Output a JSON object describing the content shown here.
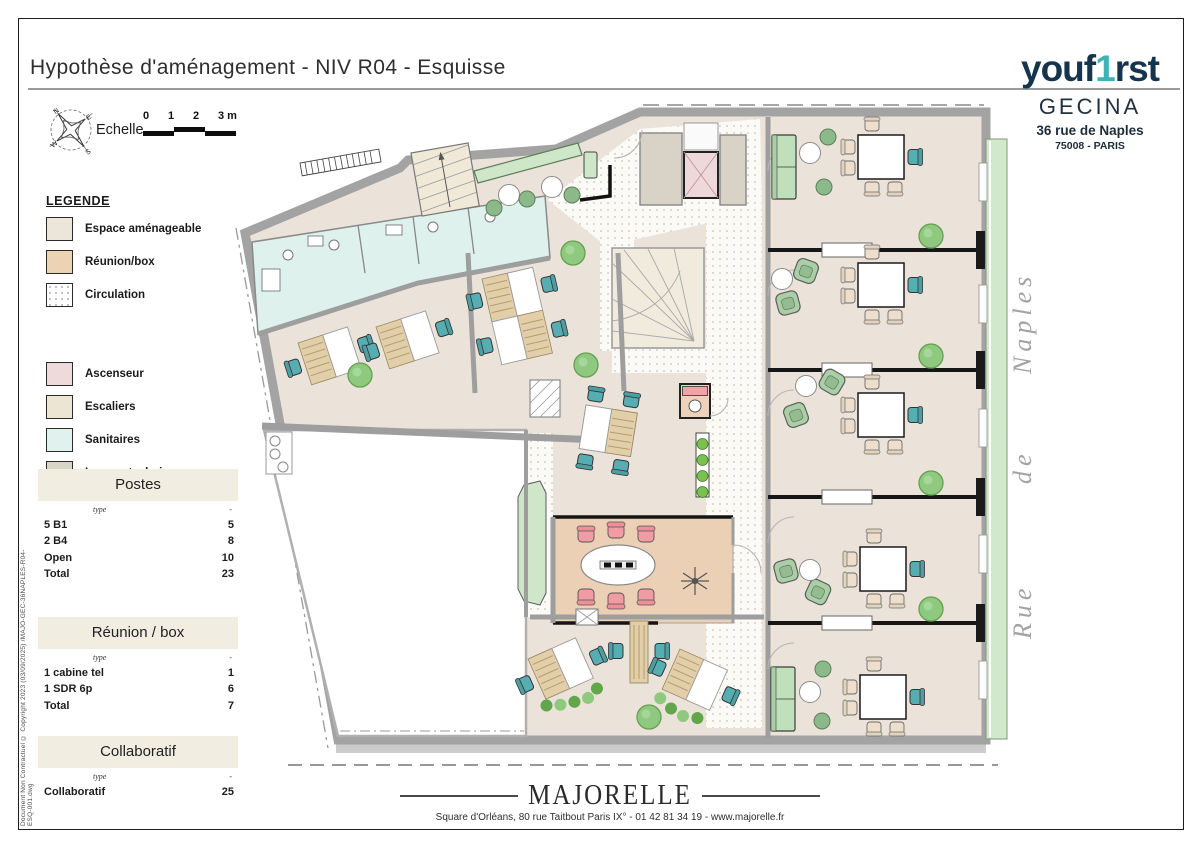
{
  "title": "Hypothèse d'aménagement - NIV R04 - Esquisse",
  "logo": {
    "part1": "youf",
    "accent": "1",
    "part2": "rst"
  },
  "client": {
    "name": "GECINA",
    "address1": "36 rue de Naples",
    "address2": "75008 - PARIS"
  },
  "scale": {
    "label": "Echelle",
    "t0": "0",
    "t1": "1",
    "t2": "2",
    "t3": "3 m"
  },
  "compass": {
    "n": "N",
    "e": "E",
    "s": "S",
    "w": "W"
  },
  "legend": {
    "title": "LEGENDE",
    "items": [
      {
        "label": "Espace aménageable",
        "color": "#ece6da"
      },
      {
        "label": "Réunion/box",
        "color": "#ecd3b4"
      },
      {
        "label": "Circulation",
        "color": "#ffffff"
      },
      {
        "label": "Ascenseur",
        "color": "#eedada"
      },
      {
        "label": "Escaliers",
        "color": "#ece5d4"
      },
      {
        "label": "Sanitaires",
        "color": "#e1f2ee"
      },
      {
        "label": "Locaux techniques",
        "color": "#d9d5c7"
      }
    ]
  },
  "tables": {
    "postes": {
      "title": "Postes",
      "type_label": "type",
      "value_label": "-",
      "rows": [
        {
          "label": "5 B1",
          "value": "5"
        },
        {
          "label": "2 B4",
          "value": "8"
        },
        {
          "label": "Open",
          "value": "10"
        },
        {
          "label": "Total",
          "value": "23"
        }
      ]
    },
    "reunion": {
      "title": "Réunion / box",
      "type_label": "type",
      "value_label": "-",
      "rows": [
        {
          "label": "1 cabine tel",
          "value": "1"
        },
        {
          "label": "1 SDR 6p",
          "value": "6"
        },
        {
          "label": "Total",
          "value": "7"
        }
      ]
    },
    "collaboratif": {
      "title": "Collaboratif",
      "type_label": "type",
      "value_label": "-",
      "rows": [
        {
          "label": "Collaboratif",
          "value": "25"
        }
      ]
    }
  },
  "street": {
    "word1": "Naples",
    "word2": "de",
    "word3": "Rue"
  },
  "footer": {
    "brand": "MAJORELLE",
    "address": "Square d'Orléans, 80 rue Taitbout Paris IX° - 01 42 81 34 19 - www.majorelle.fr"
  },
  "side_note": "Document Non Contractuel © Copyright 2023 (03/09/2025) /MAJO-GEC-36NAPLES-R04-ESQ-001.dwg",
  "colors": {
    "brand_navy": "#16344c",
    "brand_teal": "#3fb2b5"
  }
}
